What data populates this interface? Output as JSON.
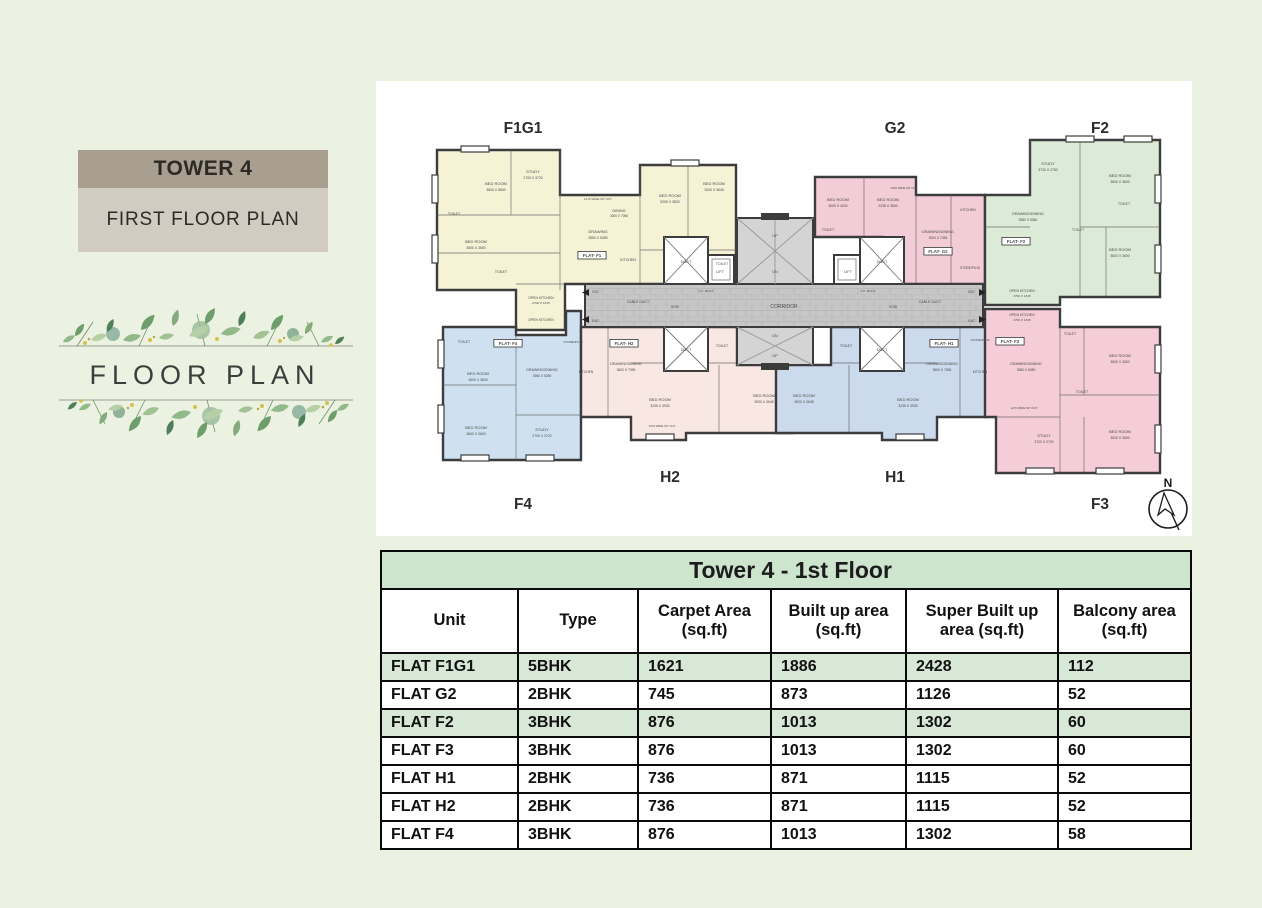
{
  "theme": {
    "page_bg": "#ecf2e1",
    "tower_bar_bg": "#a89f91",
    "plan_bar_bg": "#d1cbc2",
    "wall_color": "#3c3c3c",
    "corridor_color": "#c6c6c6",
    "greenery_palette": [
      "#6e9e6b",
      "#92b98a",
      "#b7cfa6",
      "#4f7f58",
      "#a2c295",
      "#c7d9b5",
      "#d4bf4e"
    ]
  },
  "sidebar": {
    "tower_label": "TOWER 4",
    "plan_label": "FIRST FLOOR PLAN",
    "decorative_title": "FLOOR PLAN"
  },
  "plan": {
    "compass": "N",
    "flats": {
      "f1g1": {
        "label": "F1G1",
        "color": "#f5f2d6"
      },
      "g2": {
        "label": "G2",
        "color": "#f2ccd7"
      },
      "f2": {
        "label": "F2",
        "color": "#dcead8"
      },
      "f4": {
        "label": "F4",
        "color": "#cfe1f0"
      },
      "h2": {
        "label": "H2",
        "color": "#f9e7e3"
      },
      "h1": {
        "label": "H1",
        "color": "#cbdaec"
      },
      "f3": {
        "label": "F3",
        "color": "#f4cdd8"
      }
    },
    "labels": [
      {
        "x": 120,
        "y": 100,
        "t": "BED ROOM"
      },
      {
        "x": 120,
        "y": 106,
        "t": "3600 X 5600",
        "s": 3.4
      },
      {
        "x": 157,
        "y": 88,
        "t": "STUDY"
      },
      {
        "x": 157,
        "y": 94,
        "t": "2700 X 3720",
        "s": 3.4
      },
      {
        "x": 78,
        "y": 130,
        "t": "TOILET",
        "s": 3.5
      },
      {
        "x": 100,
        "y": 158,
        "t": "BED ROOM"
      },
      {
        "x": 100,
        "y": 164,
        "t": "3600 X 3600",
        "s": 3.4
      },
      {
        "x": 125,
        "y": 188,
        "t": "TOILET",
        "s": 3.5
      },
      {
        "x": 222,
        "y": 148,
        "t": "DRAWING"
      },
      {
        "x": 222,
        "y": 154,
        "t": "3980 X 5280",
        "s": 3.4
      },
      {
        "x": 243,
        "y": 127,
        "t": "DINING",
        "s": 3.8
      },
      {
        "x": 243,
        "y": 132,
        "t": "3000 X 7055",
        "s": 3.2
      },
      {
        "x": 252,
        "y": 176,
        "t": "KITCHEN",
        "s": 3.6
      },
      {
        "x": 222,
        "y": 115,
        "t": "1270 WIDE SIT OUT",
        "s": 3
      },
      {
        "x": 294,
        "y": 112,
        "t": "BED ROOM"
      },
      {
        "x": 294,
        "y": 118,
        "t": "5205 X 3830",
        "s": 3.4
      },
      {
        "x": 338,
        "y": 100,
        "t": "BED ROOM"
      },
      {
        "x": 338,
        "y": 106,
        "t": "3000 X 3645",
        "s": 3.4
      },
      {
        "x": 346,
        "y": 180,
        "t": "TOILET",
        "s": 3.5
      },
      {
        "x": 165,
        "y": 214,
        "t": "OPEN KITCHEN",
        "s": 3.4
      },
      {
        "x": 165,
        "y": 219,
        "t": "2700 X 1815",
        "s": 3.1
      },
      {
        "x": 165,
        "y": 236,
        "t": "OPEN KITCHEN",
        "s": 3.4
      },
      {
        "x": 216,
        "y": 172,
        "t": "FLAT- F1",
        "box": 1
      },
      {
        "x": 310,
        "y": 178,
        "t": "DUCT",
        "s": 3.8
      },
      {
        "x": 344,
        "y": 188,
        "t": "LIFT",
        "s": 3.8
      },
      {
        "x": 506,
        "y": 178,
        "t": "DUCT",
        "s": 3.8
      },
      {
        "x": 472,
        "y": 188,
        "t": "LIFT",
        "s": 3.8
      },
      {
        "x": 310,
        "y": 266,
        "t": "DUCT",
        "s": 3.8
      },
      {
        "x": 506,
        "y": 266,
        "t": "DUCT",
        "s": 3.8
      },
      {
        "x": 399,
        "y": 152,
        "t": "UP",
        "s": 3.8
      },
      {
        "x": 399,
        "y": 188,
        "t": "DN",
        "s": 3.8
      },
      {
        "x": 399,
        "y": 252,
        "t": "DN",
        "s": 3.8
      },
      {
        "x": 399,
        "y": 272,
        "t": "UP",
        "s": 3.8
      },
      {
        "x": 408,
        "y": 223,
        "t": "CORRIDOR",
        "s": 5
      },
      {
        "x": 262,
        "y": 218,
        "t": "CABLE DUCT",
        "s": 3.5
      },
      {
        "x": 299,
        "y": 223,
        "t": "VOID",
        "s": 3.3
      },
      {
        "x": 554,
        "y": 218,
        "t": "CABLE DUCT",
        "s": 3.5
      },
      {
        "x": 517,
        "y": 223,
        "t": "VOID",
        "s": 3.3
      },
      {
        "x": 330,
        "y": 207,
        "t": "T.C. DUCT",
        "s": 3.1
      },
      {
        "x": 492,
        "y": 207,
        "t": "T.C. DUCT",
        "s": 3.1
      },
      {
        "x": 220,
        "y": 208,
        "t": "ENT.",
        "s": 3.3
      },
      {
        "x": 220,
        "y": 237,
        "t": "ENT.",
        "s": 3.3
      },
      {
        "x": 596,
        "y": 208,
        "t": "ENT.",
        "s": 3.3
      },
      {
        "x": 596,
        "y": 237,
        "t": "ENT.",
        "s": 3.3
      },
      {
        "x": 462,
        "y": 116,
        "t": "BED ROOM"
      },
      {
        "x": 462,
        "y": 122,
        "t": "3000 X 4000",
        "s": 3.4
      },
      {
        "x": 512,
        "y": 116,
        "t": "BED ROOM"
      },
      {
        "x": 512,
        "y": 122,
        "t": "2235 X 3830",
        "s": 3.4
      },
      {
        "x": 452,
        "y": 146,
        "t": "TOILET",
        "s": 3.5
      },
      {
        "x": 562,
        "y": 148,
        "t": "DRAWING/DINING",
        "s": 3.7
      },
      {
        "x": 562,
        "y": 154,
        "t": "3000 X 7055",
        "s": 3.3
      },
      {
        "x": 562,
        "y": 168,
        "t": "FLAT- G2",
        "box": 1
      },
      {
        "x": 592,
        "y": 126,
        "t": "KITCHEN",
        "s": 3.5
      },
      {
        "x": 594,
        "y": 184,
        "t": "STORE/PUJA",
        "s": 3.2
      },
      {
        "x": 528,
        "y": 104,
        "t": "1220 WIDE SIT OUT",
        "s": 2.9
      },
      {
        "x": 672,
        "y": 80,
        "t": "STUDY"
      },
      {
        "x": 672,
        "y": 86,
        "t": "3720 X 2780",
        "s": 3.4
      },
      {
        "x": 744,
        "y": 92,
        "t": "BED ROOM"
      },
      {
        "x": 744,
        "y": 98,
        "t": "3600 X 3600",
        "s": 3.4
      },
      {
        "x": 748,
        "y": 120,
        "t": "TOILET",
        "s": 3.5
      },
      {
        "x": 652,
        "y": 130,
        "t": "DRAWING/DINING",
        "s": 3.7
      },
      {
        "x": 652,
        "y": 136,
        "t": "3980 X 5080",
        "s": 3.3
      },
      {
        "x": 640,
        "y": 158,
        "t": "FLAT- F2",
        "box": 1
      },
      {
        "x": 744,
        "y": 166,
        "t": "BED ROOM"
      },
      {
        "x": 744,
        "y": 172,
        "t": "3600 X 3600",
        "s": 3.4
      },
      {
        "x": 702,
        "y": 146,
        "t": "TOILET",
        "s": 3.5
      },
      {
        "x": 646,
        "y": 207,
        "t": "OPEN KITCHEN",
        "s": 3.4
      },
      {
        "x": 646,
        "y": 212,
        "t": "2700 X 1815",
        "s": 3.1
      },
      {
        "x": 646,
        "y": 231,
        "t": "OPEN KITCHEN",
        "s": 3.4
      },
      {
        "x": 646,
        "y": 236,
        "t": "2700 X 1815",
        "s": 3.1
      },
      {
        "x": 88,
        "y": 258,
        "t": "TOILET",
        "s": 3.5
      },
      {
        "x": 102,
        "y": 290,
        "t": "BED ROOM"
      },
      {
        "x": 102,
        "y": 296,
        "t": "3600 X 3600",
        "s": 3.4
      },
      {
        "x": 100,
        "y": 344,
        "t": "BED ROOM"
      },
      {
        "x": 100,
        "y": 350,
        "t": "3600 X 3600",
        "s": 3.4
      },
      {
        "x": 166,
        "y": 346,
        "t": "STUDY"
      },
      {
        "x": 166,
        "y": 352,
        "t": "2700 X 3720",
        "s": 3.4
      },
      {
        "x": 166,
        "y": 286,
        "t": "DRAWING/DINING",
        "s": 3.7
      },
      {
        "x": 166,
        "y": 292,
        "t": "3980 X 5280",
        "s": 3.3
      },
      {
        "x": 132,
        "y": 260,
        "t": "FLAT- F4",
        "box": 1
      },
      {
        "x": 197,
        "y": 258,
        "t": "STORE/PUJA",
        "s": 3.1
      },
      {
        "x": 210,
        "y": 288,
        "t": "KITCHEN",
        "s": 3.3
      },
      {
        "x": 250,
        "y": 280,
        "t": "DRAWING/DINING",
        "s": 3.7
      },
      {
        "x": 250,
        "y": 286,
        "t": "3600 X 7055",
        "s": 3.3
      },
      {
        "x": 248,
        "y": 260,
        "t": "FLAT- H2",
        "box": 1
      },
      {
        "x": 284,
        "y": 316,
        "t": "BED ROOM"
      },
      {
        "x": 284,
        "y": 322,
        "t": "3235 X 3930",
        "s": 3.4
      },
      {
        "x": 388,
        "y": 312,
        "t": "BED ROOM"
      },
      {
        "x": 388,
        "y": 318,
        "t": "3000 X 3645",
        "s": 3.4
      },
      {
        "x": 346,
        "y": 262,
        "t": "TOILET",
        "s": 3.5
      },
      {
        "x": 286,
        "y": 342,
        "t": "1370 WIDE SIT OUT",
        "s": 2.9
      },
      {
        "x": 566,
        "y": 280,
        "t": "DRAWING/DINING",
        "s": 3.7
      },
      {
        "x": 566,
        "y": 286,
        "t": "3600 X 7055",
        "s": 3.3
      },
      {
        "x": 568,
        "y": 260,
        "t": "FLAT- H1",
        "box": 1
      },
      {
        "x": 532,
        "y": 316,
        "t": "BED ROOM"
      },
      {
        "x": 532,
        "y": 322,
        "t": "3235 X 3930",
        "s": 3.4
      },
      {
        "x": 428,
        "y": 312,
        "t": "BED ROOM"
      },
      {
        "x": 428,
        "y": 318,
        "t": "3000 X 3645",
        "s": 3.4
      },
      {
        "x": 470,
        "y": 262,
        "t": "TOILET",
        "s": 3.5
      },
      {
        "x": 604,
        "y": 256,
        "t": "STORE/PUJA",
        "s": 3.1
      },
      {
        "x": 604,
        "y": 288,
        "t": "KITCHEN",
        "s": 3.3
      },
      {
        "x": 650,
        "y": 280,
        "t": "DRAWING/DINING",
        "s": 3.7
      },
      {
        "x": 650,
        "y": 286,
        "t": "3980 X 5080",
        "s": 3.3
      },
      {
        "x": 634,
        "y": 258,
        "t": "FLAT- F3",
        "box": 1
      },
      {
        "x": 694,
        "y": 250,
        "t": "TOILET",
        "s": 3.5
      },
      {
        "x": 744,
        "y": 272,
        "t": "BED ROOM"
      },
      {
        "x": 744,
        "y": 278,
        "t": "3600 X 3600",
        "s": 3.4
      },
      {
        "x": 744,
        "y": 348,
        "t": "BED ROOM"
      },
      {
        "x": 744,
        "y": 354,
        "t": "3600 X 3600",
        "s": 3.4
      },
      {
        "x": 668,
        "y": 352,
        "t": "STUDY"
      },
      {
        "x": 668,
        "y": 358,
        "t": "3720 X 2700",
        "s": 3.4
      },
      {
        "x": 706,
        "y": 308,
        "t": "TOILET",
        "s": 3.5
      },
      {
        "x": 648,
        "y": 324,
        "t": "1270 WIDE SIT OUT",
        "s": 2.9
      }
    ]
  },
  "table": {
    "title": "Tower 4 - 1st Floor",
    "header_bg": "#cde4cd",
    "row_highlight_bg": "#d7e9d6",
    "columns": [
      "Unit",
      "Type",
      "Carpet Area (sq.ft)",
      "Built up area (sq.ft)",
      "Super Built up area (sq.ft)",
      "Balcony area (sq.ft)"
    ],
    "rows": [
      {
        "unit": "FLAT F1G1",
        "type": "5BHK",
        "carpet": "1621",
        "built": "1886",
        "sbu": "2428",
        "balcony": "112",
        "highlight": true
      },
      {
        "unit": "FLAT G2",
        "type": "2BHK",
        "carpet": "745",
        "built": "873",
        "sbu": "1126",
        "balcony": "52",
        "highlight": false
      },
      {
        "unit": "FLAT F2",
        "type": "3BHK",
        "carpet": "876",
        "built": "1013",
        "sbu": "1302",
        "balcony": "60",
        "highlight": true
      },
      {
        "unit": "FLAT F3",
        "type": "3BHK",
        "carpet": "876",
        "built": "1013",
        "sbu": "1302",
        "balcony": "60",
        "highlight": false
      },
      {
        "unit": "FLAT H1",
        "type": "2BHK",
        "carpet": "736",
        "built": "871",
        "sbu": "1115",
        "balcony": "52",
        "highlight": false
      },
      {
        "unit": "FLAT H2",
        "type": "2BHK",
        "carpet": "736",
        "built": "871",
        "sbu": "1115",
        "balcony": "52",
        "highlight": false
      },
      {
        "unit": "FLAT F4",
        "type": "3BHK",
        "carpet": "876",
        "built": "1013",
        "sbu": "1302",
        "balcony": "58",
        "highlight": false
      }
    ]
  }
}
